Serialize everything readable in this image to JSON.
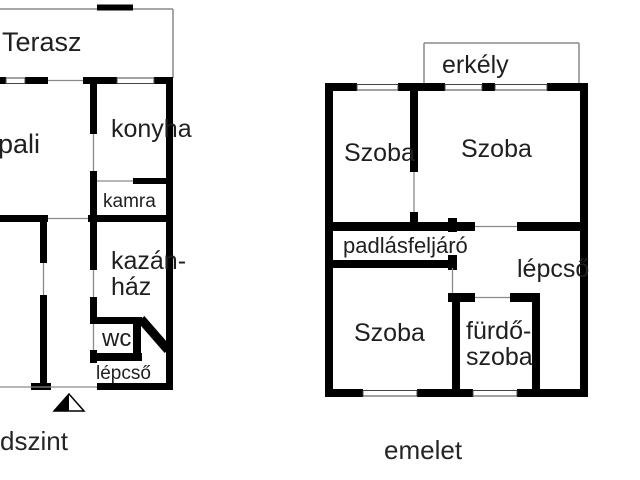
{
  "colors": {
    "wall": "#000000",
    "thin_line": "#8a8a8a",
    "text": "#1f1f1f",
    "background": "#ffffff"
  },
  "ground_floor": {
    "caption": "dszint",
    "rooms": {
      "terasz": "Terasz",
      "nappali": "pali",
      "konyha": "konyha",
      "kamra": "kamra",
      "kazanhaz_line1": "kazán-",
      "kazanhaz_line2": "ház",
      "wc": "wc",
      "lepcso": "lépcső"
    }
  },
  "upper_floor": {
    "caption": "emelet",
    "rooms": {
      "erkely": "erkély",
      "szoba_top_left": "Szoba",
      "szoba_top_right": "Szoba",
      "padlasfeljaro": "padlásfeljáró",
      "lepcso": "lépcső",
      "szoba_bottom": "Szoba",
      "furdoszoba_line1": "fürdő-",
      "furdoszoba_line2": "szoba"
    }
  }
}
